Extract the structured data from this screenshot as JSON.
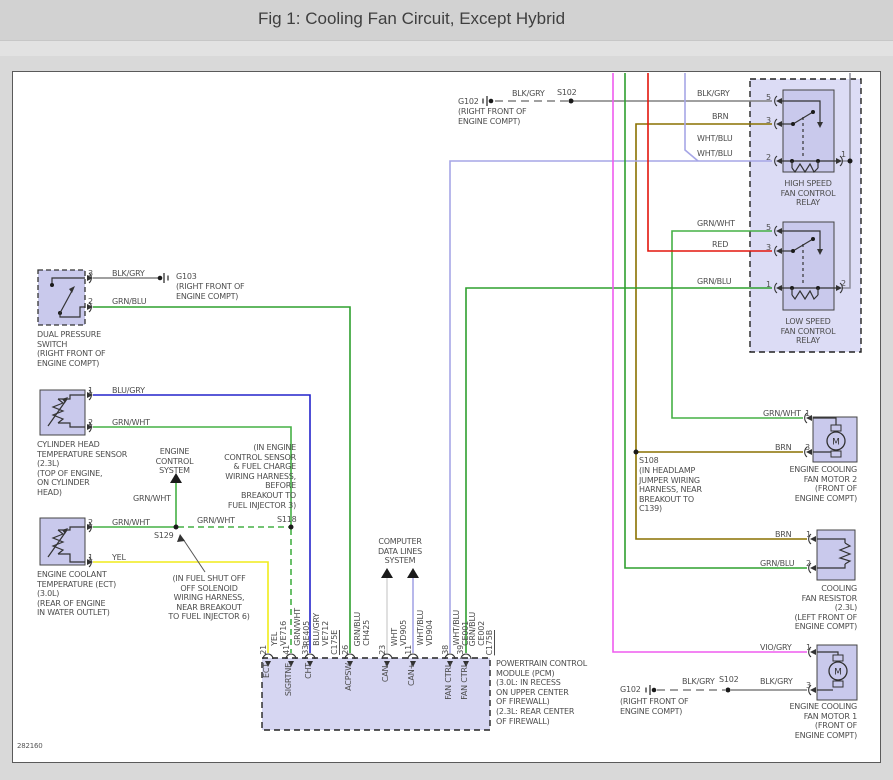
{
  "title": "Fig 1: Cooling Fan Circuit, Except Hybrid",
  "drawing_number": "282160",
  "colors": {
    "blk_gry": "#808080",
    "brn": "#8a7100",
    "wht_blu": "#a6a6e6",
    "grn_wht": "#45b045",
    "grn_blu": "#2fa02f",
    "red": "#e3170d",
    "yel": "#f0ec1a",
    "blu_gry": "#2424cc",
    "vio_gry": "#ef5cef",
    "wht": "#d8d8d8",
    "feed_gray": "#8c8c99",
    "component_fill": "#c9c9ec",
    "module_fill": "#d6d6f2"
  },
  "power_distribution": {
    "ground_g102_top": {
      "name": "G102",
      "location": "(RIGHT FRONT OF\nENGINE COMPT)",
      "wire_left": "BLK/GRY",
      "splice": "S102"
    },
    "ground_g103": {
      "name": "G103",
      "location": "(RIGHT FRONT OF\nENGINE COMPT)"
    },
    "ground_g102_bottom": {
      "name": "G102",
      "location": "(RIGHT FRONT OF\nENGINE COMPT)",
      "wire_left": "BLK/GRY",
      "splice": "S102"
    }
  },
  "relays": {
    "high_speed": {
      "caption": "HIGH SPEED\nFAN CONTROL\nRELAY",
      "pin5": "5",
      "pin3": "3",
      "pin2": "2",
      "pin1": "1",
      "wire_pin5": "BLK/GRY",
      "wire_pin3": "BRN",
      "wire_pin2_upper": "WHT/BLU",
      "wire_pin2_lower": "WHT/BLU"
    },
    "low_speed": {
      "caption": "LOW SPEED\nFAN CONTROL\nRELAY",
      "pin5": "5",
      "pin3": "3",
      "pin1": "1",
      "pin2": "2",
      "wire_pin5": "GRN/WHT",
      "wire_pin3": "RED",
      "wire_pin1": "GRN/BLU"
    }
  },
  "switches": {
    "dual_pressure": {
      "caption": "DUAL PRESSURE\nSWITCH\n(RIGHT FRONT OF\nENGINE COMPT)",
      "pin3": "3",
      "pin2": "2",
      "wire_pin3": "BLK/GRY",
      "wire_pin2": "GRN/BLU"
    }
  },
  "sensors": {
    "cht": {
      "caption": "CYLINDER HEAD\nTEMPERATURE SENSOR\n(2.3L)\n(TOP OF ENGINE,\nON CYLINDER\nHEAD)",
      "pin1": "1",
      "pin2": "2",
      "wire_pin1": "BLU/GRY",
      "wire_pin2": "GRN/WHT"
    },
    "ect": {
      "caption": "ENGINE COOLANT\nTEMPERATURE (ECT)\n(3.0L)\n(REAR OF ENGINE\nIN WATER OUTLET)",
      "pin2": "2",
      "pin1": "1",
      "wire_pin2": "GRN/WHT",
      "wire_pin1": "YEL"
    }
  },
  "splices": {
    "s129": {
      "name": "S129",
      "note": "(IN FUEL SHUT OFF\nOFF SOLENOID\nWIRING HARNESS,\nNEAR BREAKOUT\nTO FUEL INJECTOR 6)"
    },
    "s118": {
      "name": "S118",
      "wire": "GRN/WHT",
      "note": "(IN ENGINE\nCONTROL SENSOR\n& FUEL CHARGE\nWIRING HARNESS,\nBEFORE\nBREAKOUT TO\nFUEL INJECTOR 3)"
    },
    "s108": {
      "name": "S108",
      "note": "(IN HEADLAMP\nJUMPER WIRING\nHARNESS, NEAR\nBREAKOUT TO\nC139)"
    }
  },
  "system_refs": {
    "engine_control": {
      "caption": "ENGINE\nCONTROL\nSYSTEM",
      "wire": "GRN/WHT"
    },
    "computer_data_lines": {
      "caption": "COMPUTER\nDATA LINES\nSYSTEM"
    }
  },
  "motors": {
    "fan_motor_2": {
      "caption": "ENGINE COOLING\nFAN MOTOR 2\n(FRONT OF\nENGINE COMPT)",
      "pin1": "1",
      "pin3": "3",
      "wire_pin1": "GRN/WHT",
      "wire_pin3": "BRN",
      "symbol": "M"
    },
    "fan_motor_1": {
      "caption": "ENGINE COOLING\nFAN MOTOR 1\n(FRONT OF\nENGINE COMPT)",
      "pin1": "1",
      "pin3": "3",
      "wire_pin1": "VIO/GRY",
      "wire_pin3": "BLK/GRY",
      "symbol": "M"
    }
  },
  "resistor": {
    "caption": "COOLING\nFAN RESISTOR\n(2.3L)\n(LEFT FRONT OF\nENGINE COMPT)",
    "pin1": "1",
    "pin2": "2",
    "wire_pin1": "BRN",
    "wire_pin2": "GRN/BLU"
  },
  "pcm": {
    "caption": "POWERTRAIN CONTROL\nMODULE (PCM)\n(3.0L: IN RECESS\nON UPPER CENTER\nOF FIREWALL)\n(2.3L: REAR CENTER\nOF FIREWALL)",
    "pins": [
      {
        "number": "21",
        "signal": "ECT",
        "wire": "YEL",
        "circuit": "VE716"
      },
      {
        "number": "41",
        "signal": "SIGRTNE",
        "wire": "GRN/WHT",
        "circuit": "RE405"
      },
      {
        "number": "33",
        "signal": "CHT",
        "wire": "BLU/GRY",
        "circuit": "VE712"
      },
      {
        "number": "26",
        "signal": "ACPSW",
        "wire": "GRN/BLU",
        "circuit": "CH425"
      },
      {
        "number": "23",
        "signal": "CAN-",
        "wire": "WHT",
        "circuit": "VD905"
      },
      {
        "number": "11",
        "signal": "CAN+",
        "wire": "WHT/BLU",
        "circuit": "VD904"
      },
      {
        "number": "38",
        "signal": "FAN CTRL",
        "wire": "WHT/BLU",
        "circuit": "CE001"
      },
      {
        "number": "39",
        "signal": "FAN CTRL",
        "wire": "GRN/BLU",
        "circuit": "CE002"
      }
    ],
    "connector_c175e": "C175E",
    "connector_c175b": "C175B"
  }
}
